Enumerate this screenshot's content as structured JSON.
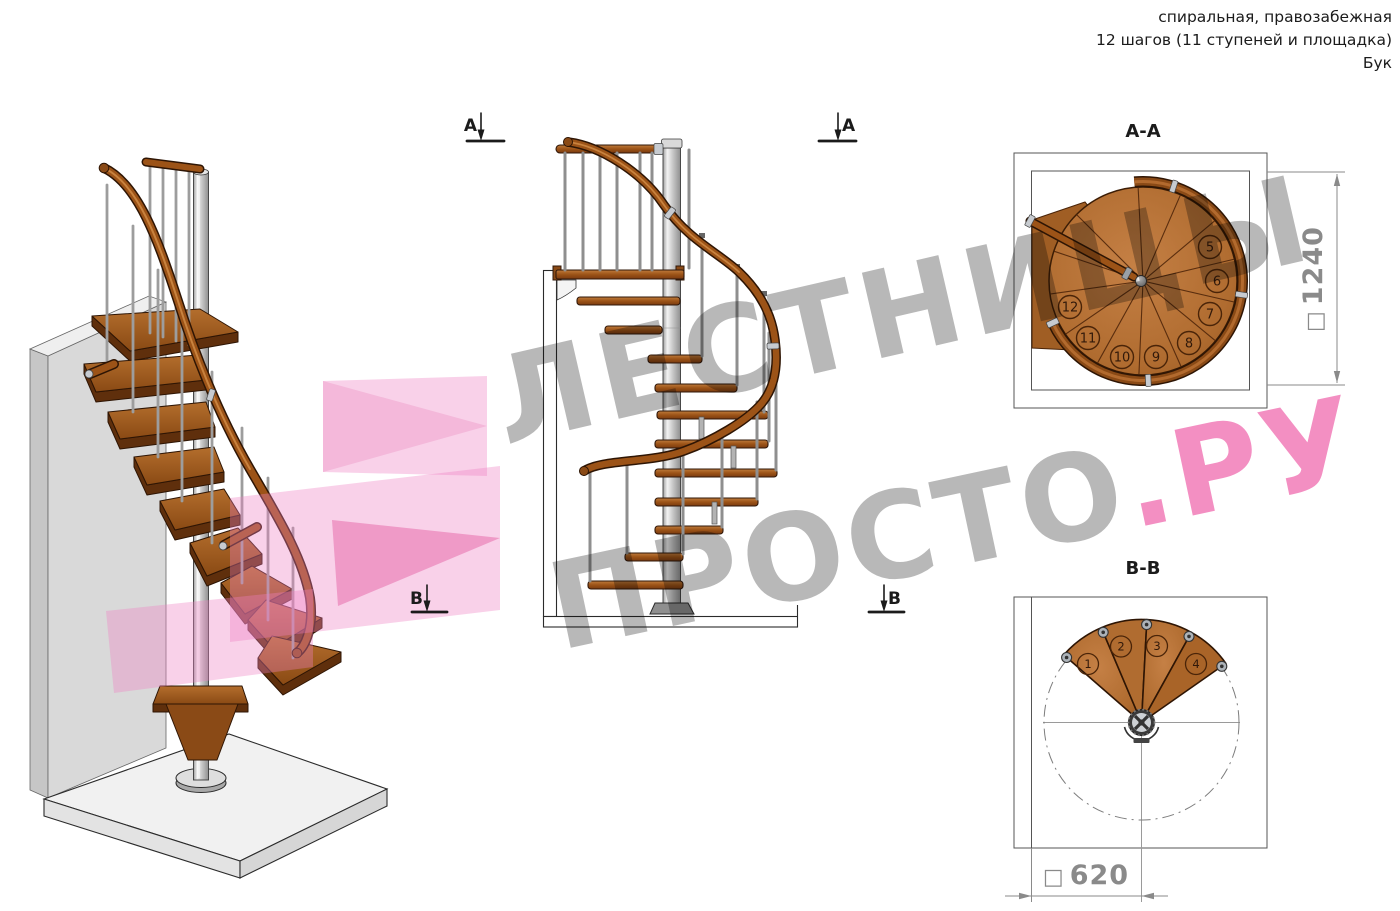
{
  "header": {
    "line1": "спиральная, правозабежная",
    "line2": "12 шагов (11 ступеней и площадка)",
    "line3": "Бук"
  },
  "watermark": {
    "line1": "ЛЕСТНИЦЫ",
    "line2_gray": "ПРОСТО",
    "line2_pink": ".РУ",
    "gray": "#a8a8a8",
    "pink": "#f176b5"
  },
  "markers": {
    "a": "А",
    "b": "В"
  },
  "views": {
    "view_3d": {
      "description": "3d-isometric-spiral-staircase"
    },
    "elevation": {
      "description": "side-elevation-spiral-staircase"
    },
    "section_aa": {
      "title": "А-А",
      "dim_symbol": "□",
      "dim_value": "1240",
      "steps": [
        "5",
        "6",
        "7",
        "8",
        "9",
        "10",
        "11",
        "12"
      ]
    },
    "section_bb": {
      "title": "В-В",
      "dim_symbol": "□",
      "dim_value": "620",
      "steps": [
        "1",
        "2",
        "3",
        "4"
      ]
    }
  },
  "colors": {
    "wood": "#9c5317",
    "wood_light": "#b06a2a",
    "wood_dark": "#5f2f0c",
    "metal": "#c7cbd0",
    "dim_gray": "#8a8a8a",
    "pink_shape": "#ef7fc1"
  }
}
